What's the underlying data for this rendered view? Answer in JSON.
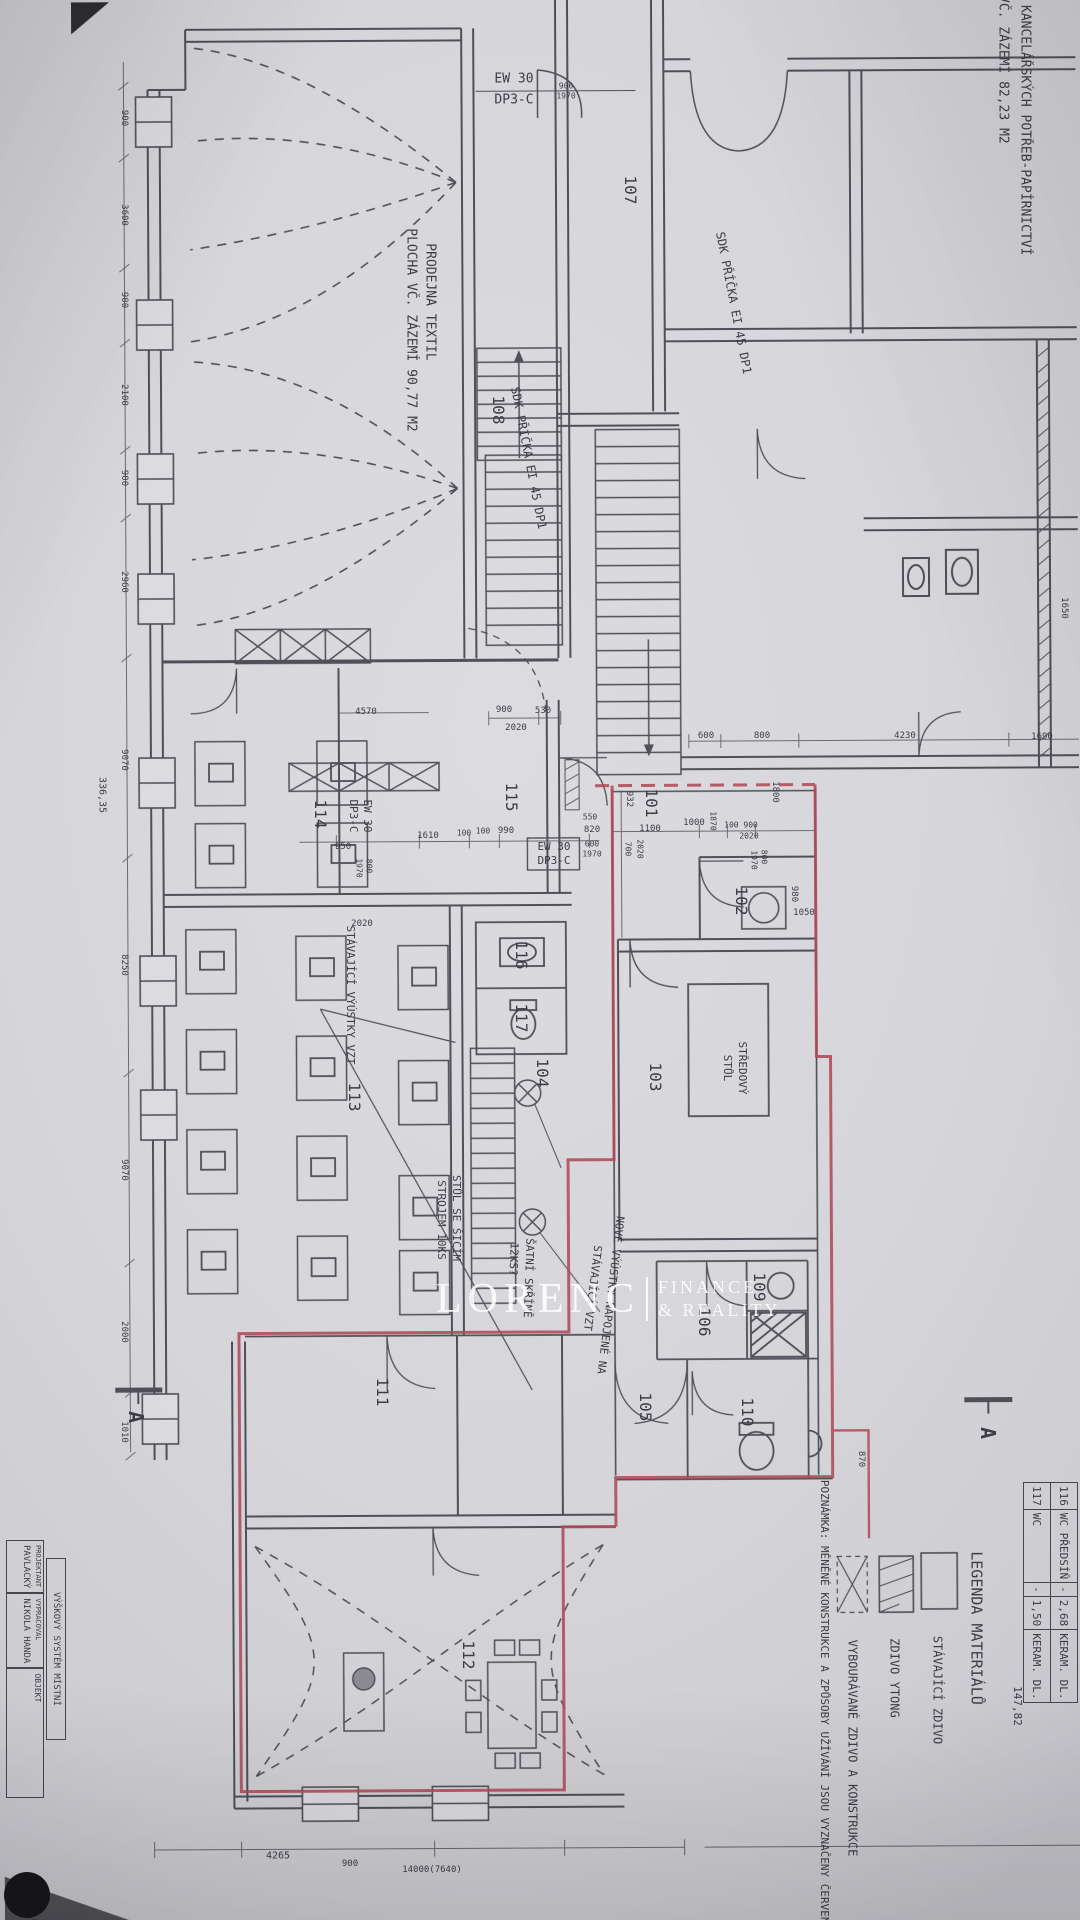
{
  "meta": {
    "paper_color": "#d5d5d9",
    "ink_color": "#3f3f49",
    "red_marking_color": "#b04a58",
    "description": "Photographed architectural floor plan, rotated 90°, with red markings for changed constructions"
  },
  "watermark": {
    "brand": "LORENC",
    "line1": "FINANCE",
    "line2": "& REALITY"
  },
  "room_table": {
    "rows": [
      [
        "116",
        "WC PŘEDSÍŇ",
        "-",
        "2,68",
        "KERAM. DL."
      ],
      [
        "117",
        "WC",
        "-",
        "1,50",
        "KERAM. DL."
      ]
    ],
    "total": "147,82"
  },
  "titleblock": {
    "note": "VÝŠKOVÝ SYSTÉM MÍSTNÍ",
    "rows": [
      {
        "label": "PROJEKTANT",
        "value": "PAVLACKÝ"
      },
      {
        "label": "VYPRACOVAL",
        "value": "NIKOLA HANDA"
      }
    ],
    "objekt_label": "OBJEKT",
    "logo_text": "PROJEKT"
  },
  "legend": {
    "title": "LEGENDA MATERIÁLŮ",
    "items": [
      {
        "swatch": "solid",
        "label": "STÁVAJÍCÍ ZDIVO"
      },
      {
        "swatch": "hatch",
        "label": "ZDIVO YTONG"
      },
      {
        "swatch": "cross-dashed",
        "label": "VYBOURÁVANÉ ZDIVO A KONSTRUKCE"
      }
    ],
    "note": "POZNÁMKA: MĚNĚNÉ KONSTRUKCE A ZPŮSOBY UŽÍVÁNÍ JSOU VYZNAČENY ČERVENĚ"
  },
  "texts": [
    {
      "n": "shop1-name",
      "t": "PRODEJNA KANCELÁŘSKÝCH POTŘEB-PAPÍRNICTVÍ",
      "x": 1024,
      "y": 95,
      "r": 90,
      "s": 13
    },
    {
      "n": "shop1-area",
      "t": "PLOCHA VČ. ZÁZEMÍ 82,23 M2",
      "x": 1002,
      "y": 42,
      "r": 90,
      "s": 13
    },
    {
      "n": "door-rating",
      "t": "EW 30",
      "x": 514,
      "y": 80,
      "r": 0,
      "s": 13
    },
    {
      "n": "door-rating",
      "t": "DP3-C",
      "x": 514,
      "y": 101,
      "r": 0,
      "s": 13
    },
    {
      "n": "dim",
      "t": "900",
      "x": 566,
      "y": 87,
      "r": 0,
      "s": 8
    },
    {
      "n": "dim",
      "t": "1970",
      "x": 566,
      "y": 97,
      "r": 0,
      "s": 8
    },
    {
      "n": "room-107",
      "t": "107",
      "x": 630,
      "y": 190,
      "r": 90,
      "s": 16
    },
    {
      "n": "partition-note",
      "t": "SDK PŘÍČKA EI 45 DP1",
      "x": 733,
      "y": 303,
      "r": 79,
      "s": 12
    },
    {
      "n": "shop2-name",
      "t": "PRODEJNA TEXTIL",
      "x": 429,
      "y": 302,
      "r": 90,
      "s": 13
    },
    {
      "n": "shop2-area",
      "t": "PLOCHA VČ. ZÁZEMÍ 90,77 M2",
      "x": 410,
      "y": 330,
      "r": 90,
      "s": 13
    },
    {
      "n": "room-108",
      "t": "108",
      "x": 498,
      "y": 410,
      "r": 90,
      "s": 16
    },
    {
      "n": "partition-note",
      "t": "SDK PŘÍČKA EI 45 DP1",
      "x": 528,
      "y": 458,
      "r": 79,
      "s": 12
    },
    {
      "n": "dim",
      "t": "900",
      "x": 124,
      "y": 118,
      "r": 90,
      "s": 9
    },
    {
      "n": "dim",
      "t": "3600",
      "x": 124,
      "y": 215,
      "r": 90,
      "s": 9
    },
    {
      "n": "dim",
      "t": "900",
      "x": 124,
      "y": 300,
      "r": 90,
      "s": 9
    },
    {
      "n": "dim",
      "t": "2100",
      "x": 124,
      "y": 395,
      "r": 90,
      "s": 9
    },
    {
      "n": "dim",
      "t": "900",
      "x": 124,
      "y": 478,
      "r": 90,
      "s": 9
    },
    {
      "n": "dim",
      "t": "2960",
      "x": 124,
      "y": 582,
      "r": 90,
      "s": 9
    },
    {
      "n": "dim",
      "t": "9070",
      "x": 124,
      "y": 760,
      "r": 90,
      "s": 9
    },
    {
      "n": "dim",
      "t": "8250",
      "x": 124,
      "y": 965,
      "r": 90,
      "s": 9
    },
    {
      "n": "dim",
      "t": "9070",
      "x": 124,
      "y": 1170,
      "r": 90,
      "s": 9
    },
    {
      "n": "dim",
      "t": "2000",
      "x": 124,
      "y": 1332,
      "r": 90,
      "s": 9
    },
    {
      "n": "dim",
      "t": "1010",
      "x": 124,
      "y": 1432,
      "r": 90,
      "s": 9
    },
    {
      "n": "dim-total",
      "t": "336,35",
      "x": 102,
      "y": 795,
      "r": 90,
      "s": 10
    },
    {
      "n": "dim",
      "t": "4570",
      "x": 366,
      "y": 712,
      "r": 0,
      "s": 9
    },
    {
      "n": "dim",
      "t": "900",
      "x": 504,
      "y": 710,
      "r": 0,
      "s": 9
    },
    {
      "n": "dim",
      "t": "530",
      "x": 543,
      "y": 711,
      "r": 0,
      "s": 9
    },
    {
      "n": "dim",
      "t": "2020",
      "x": 516,
      "y": 728,
      "r": 0,
      "s": 9
    },
    {
      "n": "dim",
      "t": "600",
      "x": 706,
      "y": 736,
      "r": 0,
      "s": 9
    },
    {
      "n": "dim",
      "t": "800",
      "x": 762,
      "y": 736,
      "r": 0,
      "s": 9
    },
    {
      "n": "dim",
      "t": "4230",
      "x": 905,
      "y": 736,
      "r": 0,
      "s": 9
    },
    {
      "n": "dim",
      "t": "1690",
      "x": 1042,
      "y": 737,
      "r": 0,
      "s": 9
    },
    {
      "n": "dim",
      "t": "1650",
      "x": 1064,
      "y": 608,
      "r": 90,
      "s": 9
    },
    {
      "n": "room-114",
      "t": "114",
      "x": 320,
      "y": 814,
      "r": 90,
      "s": 16
    },
    {
      "n": "door-rating",
      "t": "EW 30",
      "x": 367,
      "y": 816,
      "r": 90,
      "s": 11
    },
    {
      "n": "door-rating",
      "t": "DP3-C",
      "x": 353,
      "y": 816,
      "r": 90,
      "s": 11
    },
    {
      "n": "room-115",
      "t": "115",
      "x": 511,
      "y": 797,
      "r": 90,
      "s": 16
    },
    {
      "n": "door-rating",
      "t": "EW 30",
      "x": 554,
      "y": 847,
      "r": 0,
      "s": 11
    },
    {
      "n": "door-rating",
      "t": "DP3-C",
      "x": 554,
      "y": 861,
      "r": 0,
      "s": 11
    },
    {
      "n": "dim",
      "t": "950",
      "x": 343,
      "y": 847,
      "r": 0,
      "s": 9
    },
    {
      "n": "dim",
      "t": "1610",
      "x": 428,
      "y": 836,
      "r": 0,
      "s": 9
    },
    {
      "n": "dim",
      "t": "100",
      "x": 464,
      "y": 834,
      "r": 0,
      "s": 8
    },
    {
      "n": "dim",
      "t": "100",
      "x": 483,
      "y": 832,
      "r": 0,
      "s": 8
    },
    {
      "n": "dim",
      "t": "990",
      "x": 506,
      "y": 831,
      "r": 0,
      "s": 9
    },
    {
      "n": "dim",
      "t": "820",
      "x": 592,
      "y": 830,
      "r": 0,
      "s": 9
    },
    {
      "n": "dim",
      "t": "550",
      "x": 590,
      "y": 818,
      "r": 0,
      "s": 8
    },
    {
      "n": "dim",
      "t": "600",
      "x": 592,
      "y": 845,
      "r": 0,
      "s": 8
    },
    {
      "n": "dim",
      "t": "1970",
      "x": 592,
      "y": 855,
      "r": 0,
      "s": 8
    },
    {
      "n": "dim",
      "t": "800",
      "x": 368,
      "y": 866,
      "r": 90,
      "s": 8
    },
    {
      "n": "dim",
      "t": "1970",
      "x": 358,
      "y": 868,
      "r": 90,
      "s": 8
    },
    {
      "n": "room-101",
      "t": "101",
      "x": 651,
      "y": 803,
      "r": 90,
      "s": 16
    },
    {
      "n": "dim",
      "t": "932",
      "x": 629,
      "y": 799,
      "r": 90,
      "s": 9
    },
    {
      "n": "dim",
      "t": "1100",
      "x": 650,
      "y": 829,
      "r": 0,
      "s": 9
    },
    {
      "n": "dim",
      "t": "1000",
      "x": 694,
      "y": 823,
      "r": 0,
      "s": 9
    },
    {
      "n": "dim",
      "t": "1870",
      "x": 712,
      "y": 821,
      "r": 90,
      "s": 8
    },
    {
      "n": "dim",
      "t": "100 900",
      "x": 741,
      "y": 826,
      "r": 0,
      "s": 8
    },
    {
      "n": "dim",
      "t": "2020",
      "x": 749,
      "y": 837,
      "r": 0,
      "s": 8
    },
    {
      "n": "dim",
      "t": "700",
      "x": 627,
      "y": 849,
      "r": 90,
      "s": 8
    },
    {
      "n": "dim",
      "t": "2020",
      "x": 639,
      "y": 849,
      "r": 90,
      "s": 8
    },
    {
      "n": "dim",
      "t": "1970",
      "x": 753,
      "y": 860,
      "r": 90,
      "s": 8
    },
    {
      "n": "dim",
      "t": "800",
      "x": 763,
      "y": 857,
      "r": 90,
      "s": 8
    },
    {
      "n": "dim",
      "t": "1800",
      "x": 775,
      "y": 792,
      "r": 90,
      "s": 9
    },
    {
      "n": "dim",
      "t": "980",
      "x": 794,
      "y": 894,
      "r": 90,
      "s": 9
    },
    {
      "n": "dim",
      "t": "1050",
      "x": 804,
      "y": 913,
      "r": 0,
      "s": 9
    },
    {
      "n": "room-102",
      "t": "102",
      "x": 741,
      "y": 901,
      "r": 90,
      "s": 16
    },
    {
      "n": "room-116",
      "t": "116",
      "x": 521,
      "y": 955,
      "r": 90,
      "s": 16
    },
    {
      "n": "room-117",
      "t": "117",
      "x": 521,
      "y": 1018,
      "r": 90,
      "s": 16
    },
    {
      "n": "dim",
      "t": "2020",
      "x": 362,
      "y": 924,
      "r": 0,
      "s": 9
    },
    {
      "n": "vent-note",
      "t": "STÁVAJÍCÍ VÝÚSTKY VZT",
      "x": 350,
      "y": 995,
      "r": 90,
      "s": 11
    },
    {
      "n": "room-113",
      "t": "113",
      "x": 354,
      "y": 1097,
      "r": 90,
      "s": 16
    },
    {
      "n": "room-103",
      "t": "103",
      "x": 655,
      "y": 1077,
      "r": 90,
      "s": 16
    },
    {
      "n": "room-104",
      "t": "104",
      "x": 542,
      "y": 1073,
      "r": 90,
      "s": 16
    },
    {
      "n": "table-note",
      "t": "STŘEDOVÝ",
      "x": 742,
      "y": 1068,
      "r": 90,
      "s": 11
    },
    {
      "n": "table-note",
      "t": "STŮL",
      "x": 727,
      "y": 1068,
      "r": 90,
      "s": 11
    },
    {
      "n": "sewing-note",
      "t": "STŮL SE ŠICÍM",
      "x": 456,
      "y": 1218,
      "r": 90,
      "s": 11
    },
    {
      "n": "sewing-note",
      "t": "STROJEM 10KS",
      "x": 441,
      "y": 1220,
      "r": 90,
      "s": 11
    },
    {
      "n": "locker-note",
      "t": "ŠATNÍ SKŘÍNĚ",
      "x": 528,
      "y": 1278,
      "r": 92,
      "s": 11
    },
    {
      "n": "locker-note",
      "t": "12KS?",
      "x": 513,
      "y": 1259,
      "r": 92,
      "s": 11
    },
    {
      "n": "vent-note",
      "t": "NOVÉ VÝÚSTKY NAPOJENÉ NA",
      "x": 610,
      "y": 1295,
      "r": 97,
      "s": 11
    },
    {
      "n": "vent-note",
      "t": "STÁVAJÍCÍ VZT",
      "x": 592,
      "y": 1288,
      "r": 97,
      "s": 11
    },
    {
      "n": "room-106",
      "t": "106",
      "x": 704,
      "y": 1322,
      "r": 90,
      "s": 16
    },
    {
      "n": "room-109",
      "t": "109",
      "x": 759,
      "y": 1287,
      "r": 90,
      "s": 16
    },
    {
      "n": "room-105",
      "t": "105",
      "x": 645,
      "y": 1407,
      "r": 90,
      "s": 16
    },
    {
      "n": "room-110",
      "t": "110",
      "x": 747,
      "y": 1412,
      "r": 90,
      "s": 16
    },
    {
      "n": "room-111",
      "t": "111",
      "x": 382,
      "y": 1392,
      "r": 90,
      "s": 16
    },
    {
      "n": "room-112",
      "t": "112",
      "x": 468,
      "y": 1655,
      "r": 90,
      "s": 16
    },
    {
      "n": "section-mark-a",
      "t": "A",
      "x": 136,
      "y": 1417,
      "r": 90,
      "s": 20,
      "w": 700
    },
    {
      "n": "section-mark-a",
      "t": "A",
      "x": 988,
      "y": 1433,
      "r": 90,
      "s": 20,
      "w": 700
    },
    {
      "n": "dim",
      "t": "870",
      "x": 861,
      "y": 1459,
      "r": 90,
      "s": 9
    },
    {
      "n": "legend-title",
      "t": "LEGENDA MATERIÁLŮ",
      "x": 976,
      "y": 1628,
      "r": 90,
      "s": 15
    },
    {
      "n": "legend-item",
      "t": "STÁVAJÍCÍ ZDIVO",
      "x": 937,
      "y": 1690,
      "r": 90,
      "s": 12
    },
    {
      "n": "legend-item",
      "t": "ZDIVO YTONG",
      "x": 894,
      "y": 1678,
      "r": 90,
      "s": 12
    },
    {
      "n": "legend-item",
      "t": "VYBOURÁVANÉ ZDIVO A KONSTRUKCE",
      "x": 852,
      "y": 1748,
      "r": 90,
      "s": 12
    },
    {
      "n": "legend-note",
      "t": "POZNÁMKA: MĚNĚNÉ KONSTRUKCE A ZPŮSOBY UŽÍVÁNÍ JSOU VYZNAČENY ČERVENĚ",
      "x": 824,
      "y": 1705,
      "r": 90,
      "s": 11
    },
    {
      "n": "table-total",
      "t": "147,82",
      "x": 1017,
      "y": 1706,
      "r": 90,
      "s": 11
    },
    {
      "n": "dim",
      "t": "4265",
      "x": 278,
      "y": 1856,
      "r": 0,
      "s": 10
    },
    {
      "n": "dim",
      "t": "900",
      "x": 350,
      "y": 1864,
      "r": 0,
      "s": 9
    },
    {
      "n": "dim",
      "t": "14000(7640)",
      "x": 432,
      "y": 1870,
      "r": 0,
      "s": 9
    }
  ]
}
